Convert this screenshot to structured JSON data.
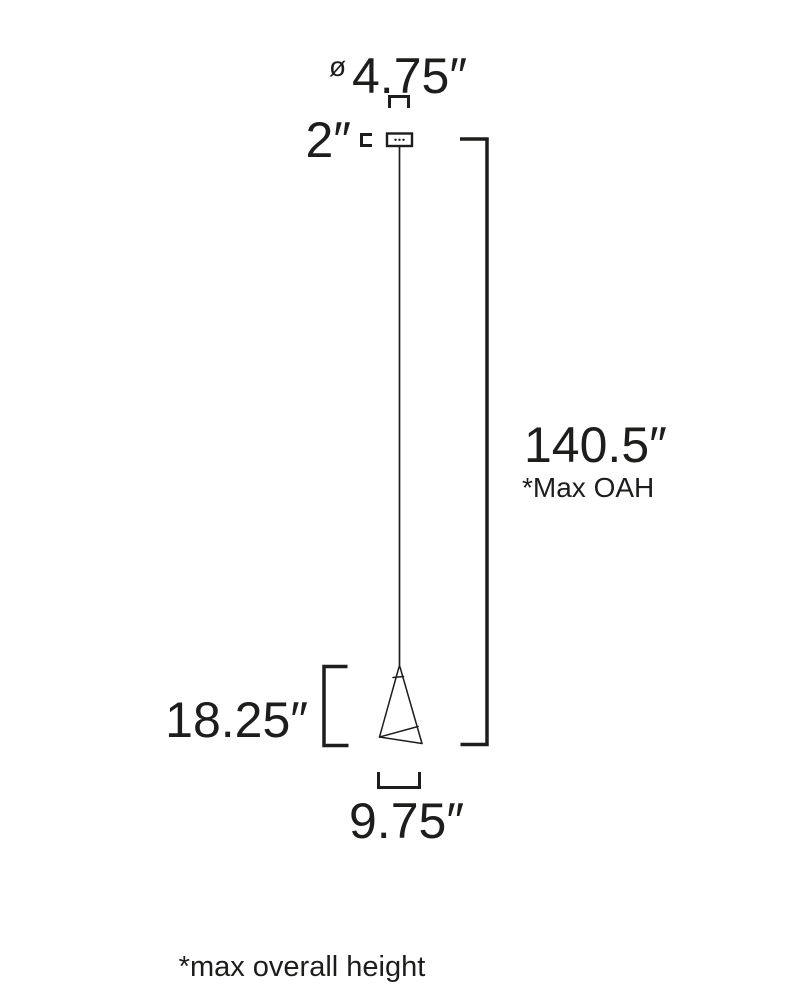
{
  "diagram": {
    "type": "product-dimension-drawing",
    "subject": "cone pendant light fixture",
    "background_color": "#ffffff",
    "line_color": "#1d1d1b",
    "labels": {
      "diameter_symbol": "ø",
      "canopy_diameter": "4.75″",
      "canopy_height": "2″",
      "max_overall_height": "140.5″",
      "max_overall_height_note": "*Max OAH",
      "fixture_height": "18.25″",
      "fixture_width": "9.75″",
      "footnote": "*max overall height"
    }
  }
}
